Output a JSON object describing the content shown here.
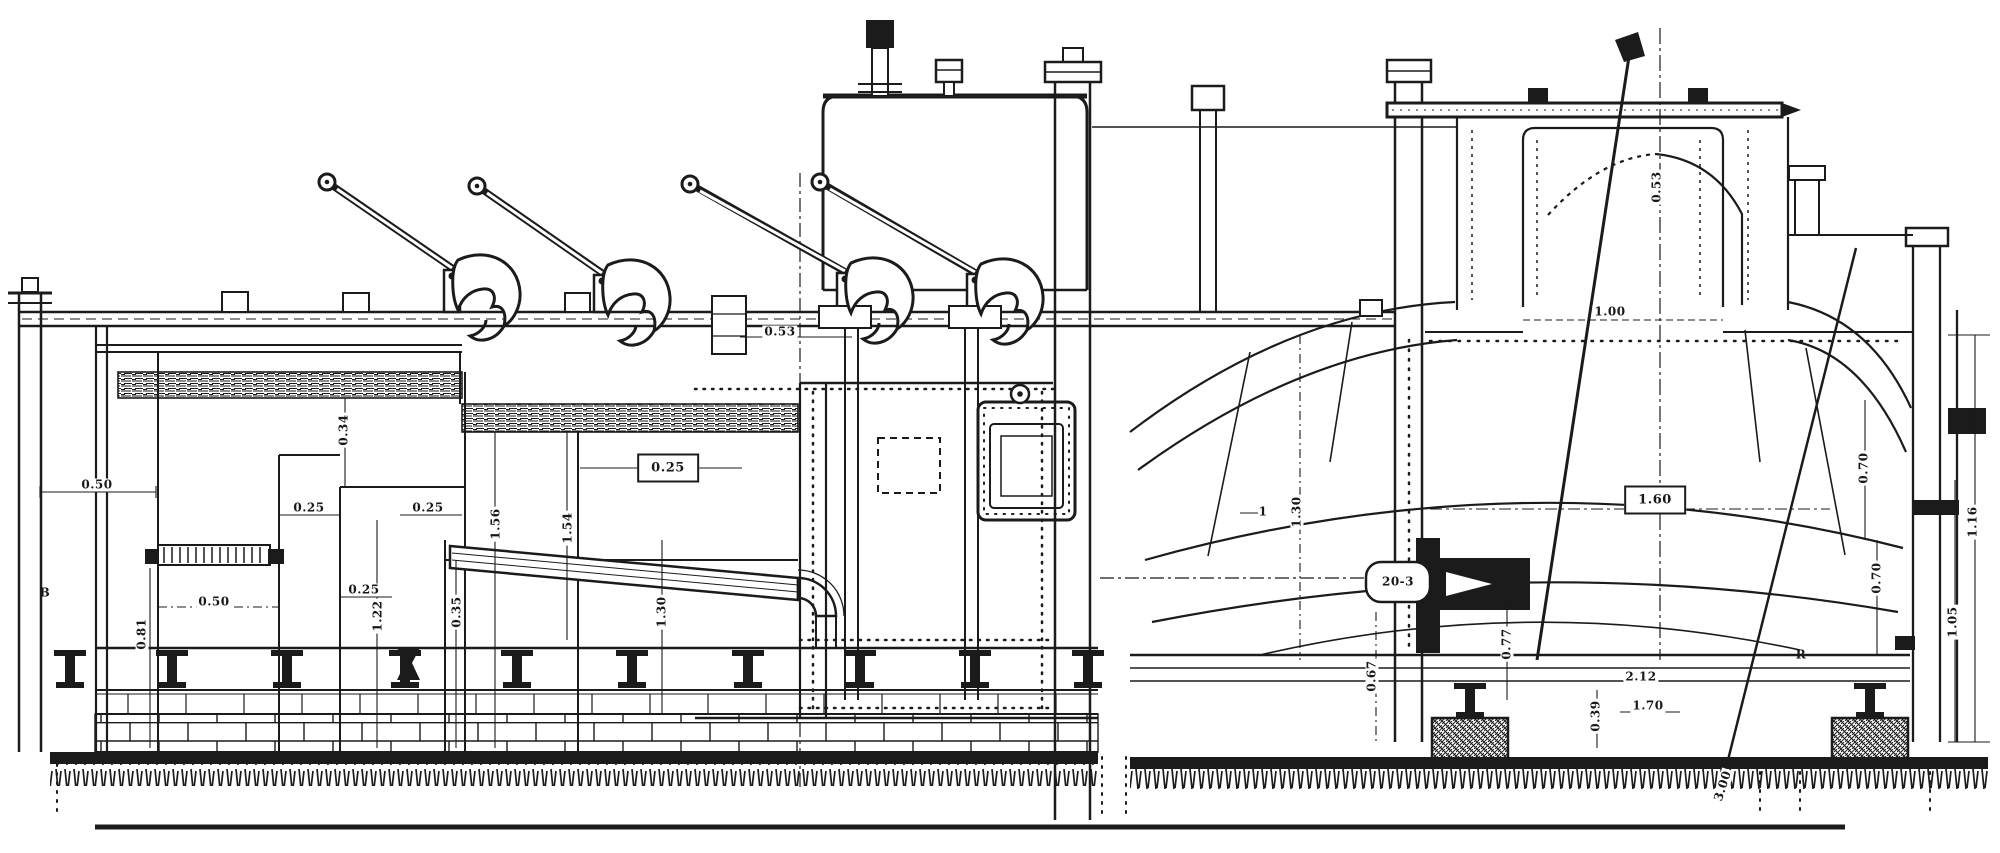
{
  "document": {
    "kind": "sectional elevation engraving of an industrial furnace installation",
    "palette": {
      "background": "#ffffff",
      "ink": "#1b1b1b"
    }
  },
  "labels": [
    {
      "text": "0.50"
    },
    {
      "text": "B"
    },
    {
      "text": "0.50"
    },
    {
      "text": "0.81"
    },
    {
      "text": "0.34"
    },
    {
      "text": "0.25"
    },
    {
      "text": "0.25"
    },
    {
      "text": "0.25"
    },
    {
      "text": "1.22"
    },
    {
      "text": "0.35"
    },
    {
      "text": "1.56"
    },
    {
      "text": "1.54"
    },
    {
      "text": "0.25"
    },
    {
      "text": "0.53"
    },
    {
      "text": "1.30"
    },
    {
      "text": "1.30"
    },
    {
      "text": "20-3"
    },
    {
      "text": "0.67"
    },
    {
      "text": "0.77"
    },
    {
      "text": "1.00"
    },
    {
      "text": "0.53"
    },
    {
      "text": "1.60"
    },
    {
      "text": "0.70"
    },
    {
      "text": "0.70"
    },
    {
      "text": "1.16"
    },
    {
      "text": "1.05"
    },
    {
      "text": "2.12"
    },
    {
      "text": "1.70"
    },
    {
      "text": "0.39"
    },
    {
      "text": "3.00"
    },
    {
      "text": "R"
    },
    {
      "text": "1"
    }
  ]
}
